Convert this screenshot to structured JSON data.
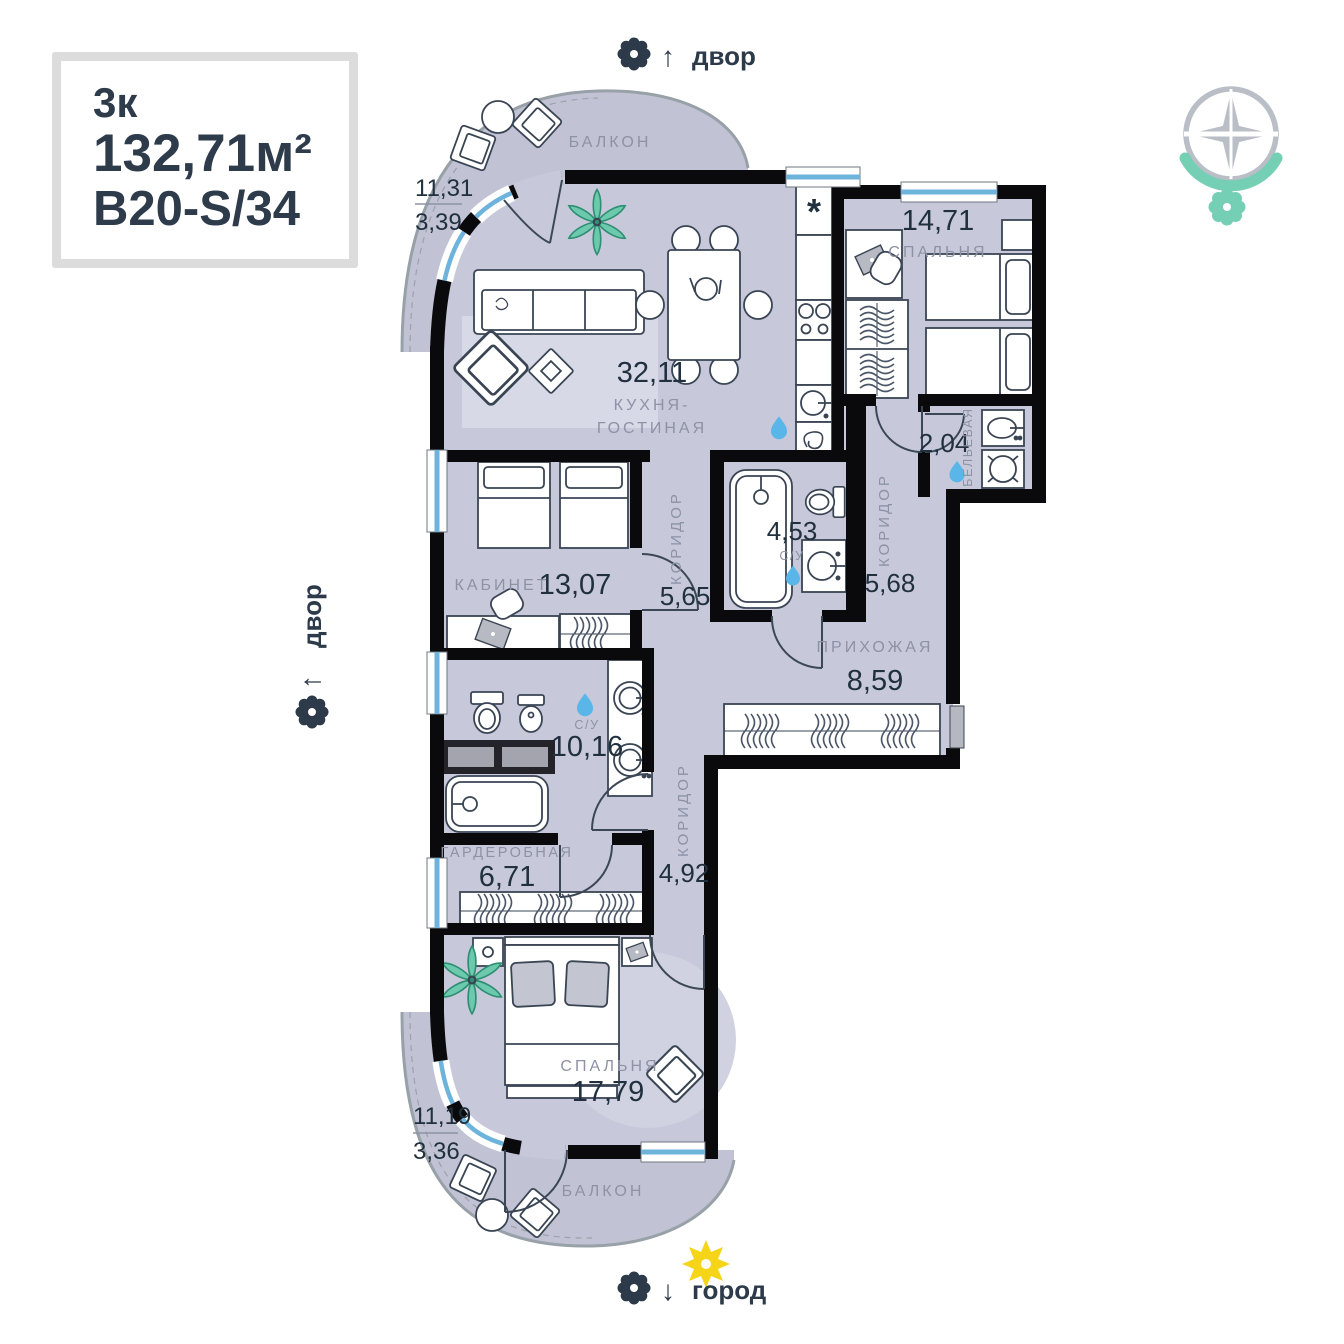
{
  "info_box": {
    "type": "3к",
    "area": "132,71м²",
    "code": "В20-S/34"
  },
  "markers": {
    "top": {
      "arrow": "↑",
      "label": "двор"
    },
    "left": {
      "arrow": "↑",
      "label": "двор"
    },
    "bottom": {
      "arrow": "↓",
      "label": "город"
    }
  },
  "icons": {
    "fridge": "*"
  },
  "rooms": {
    "balcony_top": {
      "name": "БАЛКОН",
      "area_total": "11,31",
      "area_reduced": "3,39"
    },
    "kitchen_living": {
      "area": "32,11",
      "name_line1": "КУХНЯ-",
      "name_line2": "ГОСТИНАЯ"
    },
    "bedroom_1": {
      "area": "14,71",
      "name": "СПАЛЬНЯ"
    },
    "linen": {
      "area": "2,04",
      "name": "БЕЛЬЕВАЯ"
    },
    "corridor_1": {
      "area": "5,65",
      "name": "КОРИДОР"
    },
    "bathroom_1": {
      "area": "4,53",
      "name": "С/У"
    },
    "corridor_2": {
      "area": "5,68",
      "name": "КОРИДОР"
    },
    "office": {
      "area": "13,07",
      "name": "КАБИНЕТ"
    },
    "hallway": {
      "area": "8,59",
      "name": "ПРИХОЖАЯ"
    },
    "bathroom_2": {
      "area": "10,16",
      "name": "С/У"
    },
    "wardrobe": {
      "area": "6,71",
      "name": "ГАРДЕРОБНАЯ"
    },
    "corridor_3": {
      "area": "4,92",
      "name": "КОРИДОР"
    },
    "bedroom_2": {
      "area": "17,79",
      "name": "СПАЛЬНЯ"
    },
    "balcony_bottom": {
      "name": "БАЛКОН",
      "area_total": "11,19",
      "area_reduced": "3,36"
    }
  },
  "colors": {
    "floor": "#c7c9db",
    "balcony": "#c1c3d4",
    "wall": "#0a0a0c",
    "window_glass": "#6db3dc",
    "accent_teal": "#6fcfb4",
    "water_drop": "#5ab5e8",
    "sun": "#f6d418",
    "label_gray": "#8d92a5",
    "number_dark": "#20303e"
  }
}
